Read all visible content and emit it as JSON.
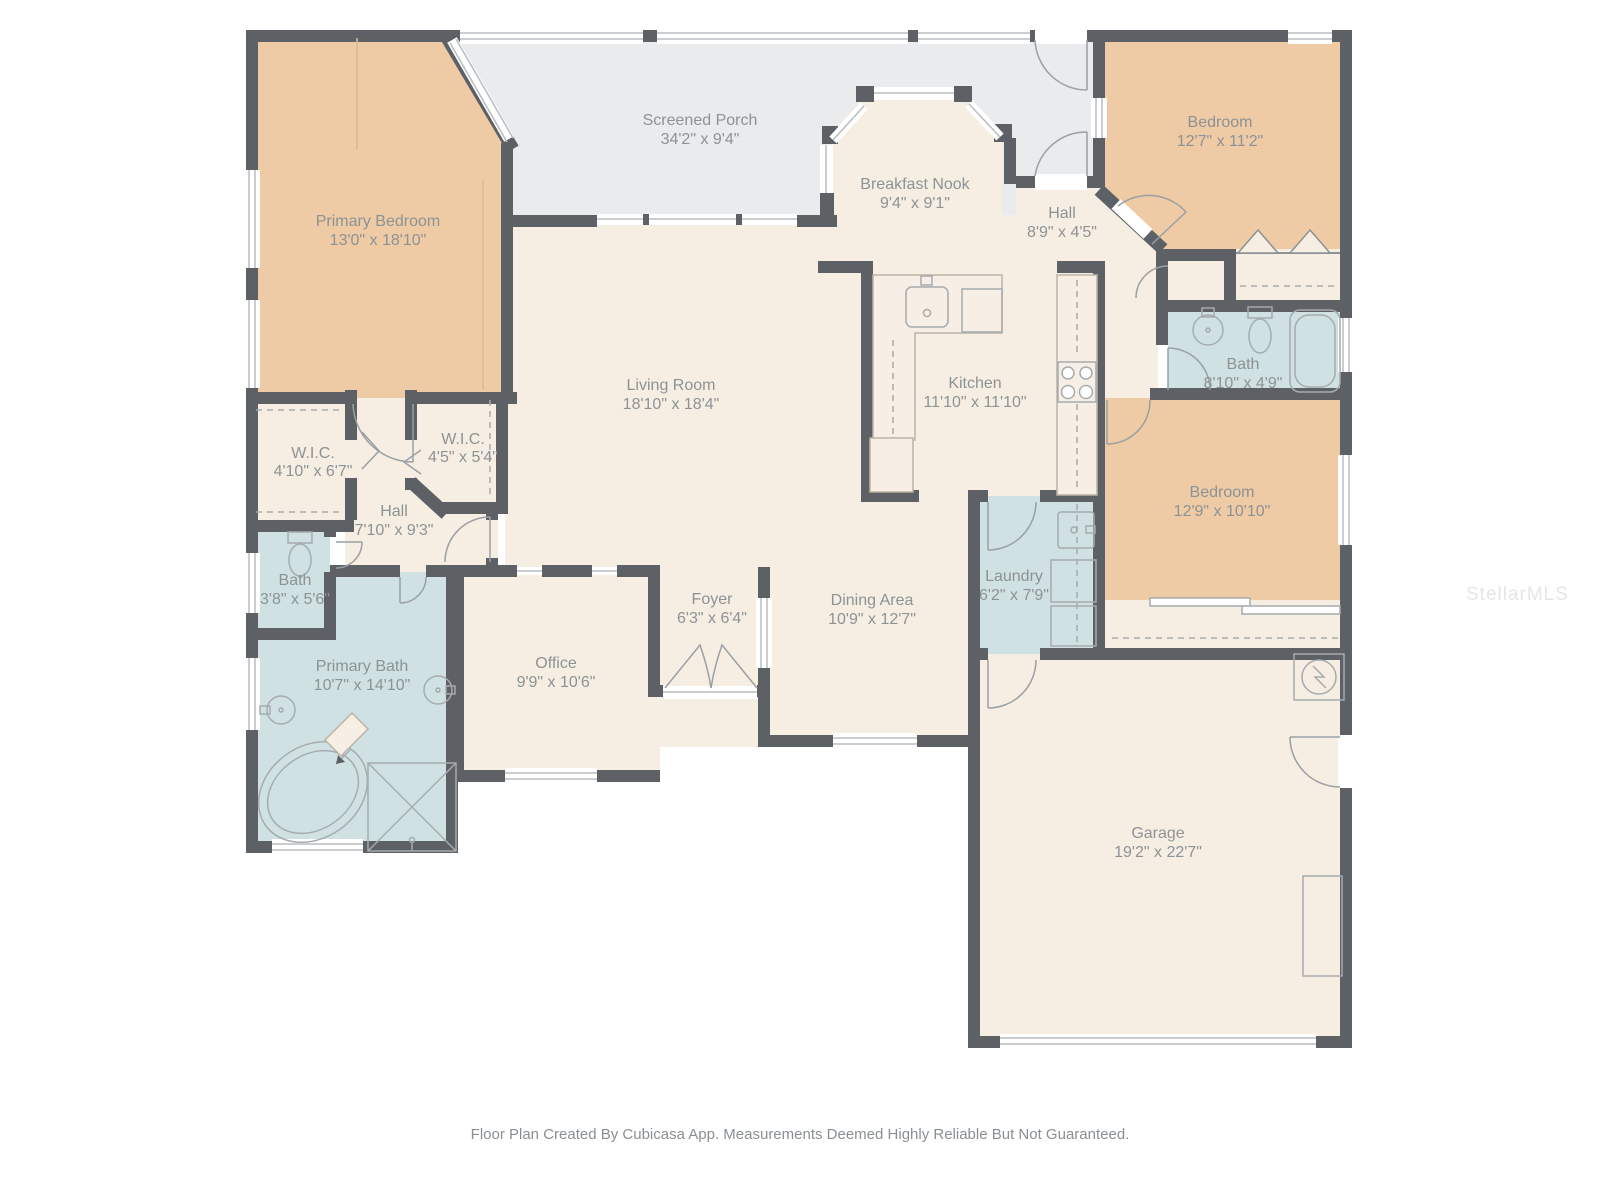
{
  "meta": {
    "footer": "Floor Plan Created By Cubicasa App. Measurements Deemed Highly Reliable But Not Guaranteed.",
    "watermark": "StellarMLS"
  },
  "palette": {
    "wall": "#5d6165",
    "floor": "#f6eee3",
    "bedroom_fill": "#eecaa5",
    "bath_fill": "#cfe1e2",
    "porch_fill": "#e9ebed",
    "label_text": "#8d9295",
    "fixture_line": "#a6abae"
  },
  "rooms": [
    {
      "id": "screened_porch",
      "name": "Screened Porch",
      "dims": "34'2\" x 9'4\""
    },
    {
      "id": "primary_bedroom",
      "name": "Primary Bedroom",
      "dims": "13'0\" x 18'10\""
    },
    {
      "id": "breakfast_nook",
      "name": "Breakfast Nook",
      "dims": "9'4\" x 9'1\""
    },
    {
      "id": "hall_upper",
      "name": "Hall",
      "dims": "8'9\" x 4'5\""
    },
    {
      "id": "bedroom_top_right",
      "name": "Bedroom",
      "dims": "12'7\" x 11'2\""
    },
    {
      "id": "bath_right",
      "name": "Bath",
      "dims": "8'10\" x 4'9\""
    },
    {
      "id": "living_room",
      "name": "Living Room",
      "dims": "18'10\" x 18'4\""
    },
    {
      "id": "kitchen",
      "name": "Kitchen",
      "dims": "11'10\" x 11'10\""
    },
    {
      "id": "bedroom_right",
      "name": "Bedroom",
      "dims": "12'9\" x 10'10\""
    },
    {
      "id": "wic_left",
      "name": "W.I.C.",
      "dims": "4'10\" x 6'7\""
    },
    {
      "id": "wic_right",
      "name": "W.I.C.",
      "dims": "4'5\" x 5'4\""
    },
    {
      "id": "hall_left",
      "name": "Hall",
      "dims": "7'10\" x 9'3\""
    },
    {
      "id": "bath_left",
      "name": "Bath",
      "dims": "3'8\" x 5'6\""
    },
    {
      "id": "primary_bath",
      "name": "Primary Bath",
      "dims": "10'7\" x 14'10\""
    },
    {
      "id": "office",
      "name": "Office",
      "dims": "9'9\" x 10'6\""
    },
    {
      "id": "foyer",
      "name": "Foyer",
      "dims": "6'3\" x 6'4\""
    },
    {
      "id": "dining_area",
      "name": "Dining Area",
      "dims": "10'9\" x 12'7\""
    },
    {
      "id": "laundry",
      "name": "Laundry",
      "dims": "6'2\" x 7'9\""
    },
    {
      "id": "garage",
      "name": "Garage",
      "dims": "19'2\" x 22'7\""
    }
  ]
}
